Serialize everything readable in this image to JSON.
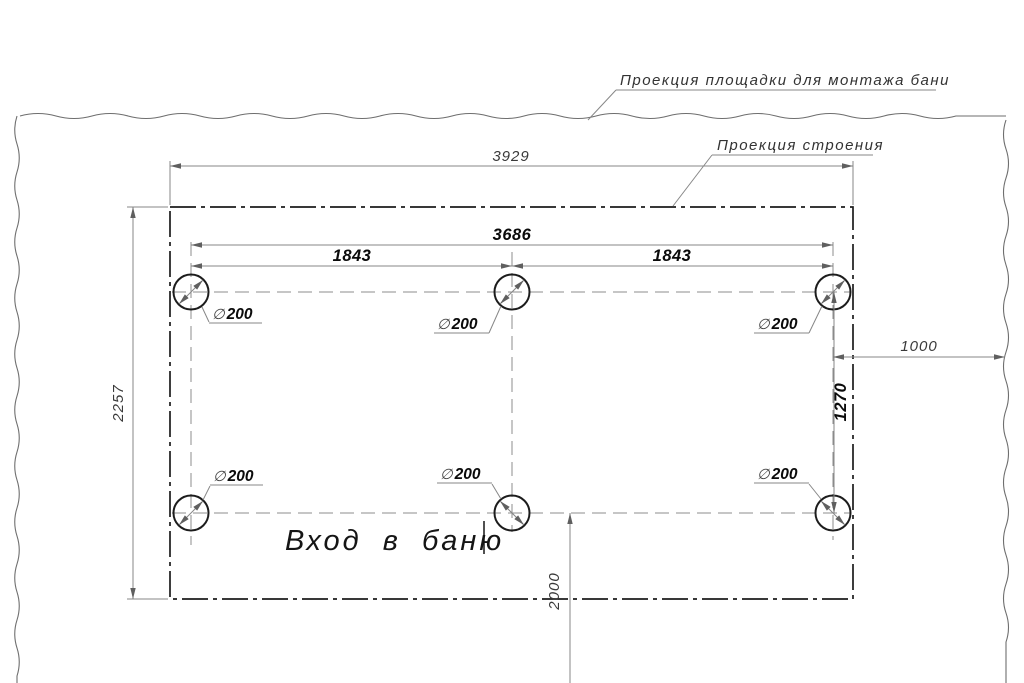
{
  "callouts": {
    "platform_label": "Проекция площадки для монтажа бани",
    "building_label": "Проекция строения"
  },
  "dimensions": {
    "overall_width": "3929",
    "pile_span_width": "3686",
    "pile_spacing": "1843",
    "overall_depth": "2257",
    "pile_row_spacing": "1270",
    "right_edge_offset": "1000",
    "entrance_axis_offset": "2000"
  },
  "piles": {
    "diameter_symbol": "∅",
    "diameter_value": "200"
  },
  "annotations": {
    "entrance_text": "Вход в баню"
  }
}
